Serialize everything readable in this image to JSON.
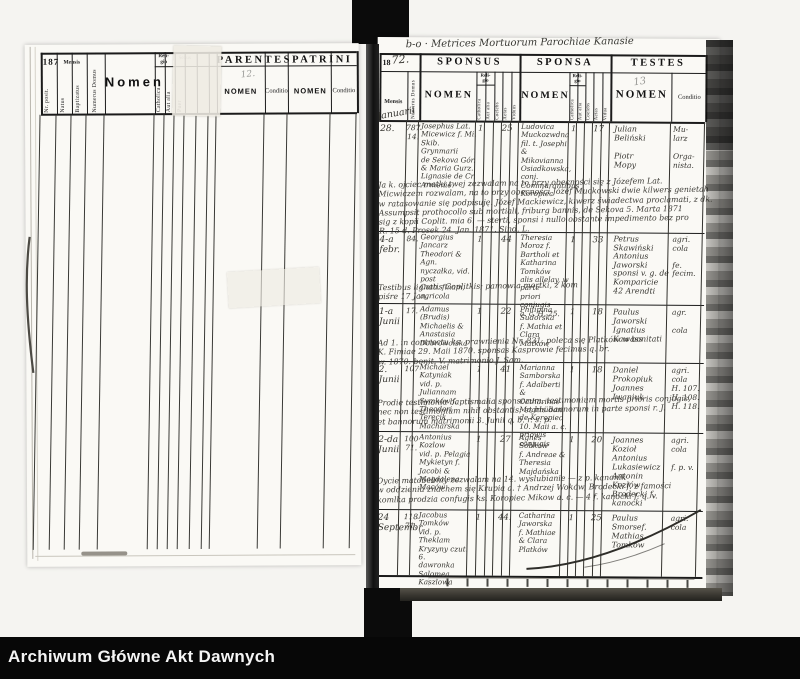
{
  "archive_bar": {
    "label": "Archiwum Główne Akt Dawnych"
  },
  "left_page": {
    "year": "187",
    "pencil_note": "12.",
    "header": {
      "nr_posit": "Nr. posit.",
      "mensis": "Mensis",
      "natus": "Natus",
      "baptizatus": "Baptizatus",
      "numerus_domus": "Numerus Domus",
      "nomen": "Nomen",
      "religio": "Reli-\ngio",
      "catholica": "Catholica",
      "aut_alia": "Aut alia",
      "sexus": "Sexus",
      "puer": "Puer",
      "parentes": "PARENTES",
      "parentes_nomen": "NOMEN",
      "parentes_conditio": "Conditio",
      "patrini": "PATRINI",
      "patrini_nomen": "NOMEN",
      "patrini_conditio": "Conditio"
    }
  },
  "right_page": {
    "title_hw": "b-o  ·  Metrices Mortuorum Parochiae Kanasie",
    "year_printed": "18",
    "year_hw": "72.",
    "page_no_hw": "13",
    "header": {
      "mensis": "Mensis",
      "mensis_hw": "Januarii",
      "numerus_domus": "Numerus Domus",
      "sponsus": "SPONSUS",
      "sponsa": "SPONSA",
      "testes": "TESTES",
      "nomen_sponsus": "NOMEN",
      "nomen_sponsa": "NOMEN",
      "nomen_testes": "NOMEN",
      "religio": "Reli-\ngio",
      "catholica": "Catholica",
      "aut_alia": "Aut alia",
      "coelebs": "Coelebs",
      "aetas": "Aetas",
      "viduus": "Viduus",
      "vidua": "Vidua",
      "conditio": "Conditio"
    },
    "rows": [
      {
        "mensis": "28.",
        "domus": "787\n14.",
        "sponsus": "Josephus Lat.\nMicewicz f. Mi.\nSkib. Grynmarii\nde Sekova Gór.\n& Maria Gurz.\nLignasie de Cr.\nArmenie.",
        "s_cath": "1",
        "s_aetas": "25",
        "sponsa": "Ludovica\nMuckozwdna\nfil. t. Josephi\n& Mikovianna\nOsiadkowska, conj.\nCommurantibus\nKoropiec",
        "sp_cath": "1",
        "sp_aetas": "17",
        "testes": "Julian\nBeliński\n\nPiotr\nMopy",
        "conditio": "Mu-\nlarz\n\nOrga-\nnista.",
        "note": "Ja k. ojciec matki twej zezwalam na to przy obecności się z Józefem Lat.\nMicwiczem rozwalam, na to przy obecności Józef Muckowski dwie kilwers genietah\nw ratasowanie się podpisuję. Józef Mackiewicz, kiwerz świadectwa proclamati, z dk.\nAssumpsit prothocollo sub mortiali, friburg bannis, de Sekova 5. Marta 1871\nsig z kopii Coplit. mia 6. — sterti, sponsi i nullo obstante impedimento bez pro\nR. 15 d. Prosek 24. Jan. 1871.  Sind. L."
      },
      {
        "mensis": "4-a\nfebr.",
        "domus": "84.",
        "sponsus": "Georgius\nJancarz\nTheodori & Agn.\nnyczałka, vid. post\nCath. finam, agricola",
        "s_cath": "1",
        "s_aetas": "44",
        "sponsa": "Theresia\nMoroz f.\nBartholi et\nKatharina\nTomków\nalis allelay, w parte\npriori conjugis\na. c. H. 25.",
        "sp_cath": "1",
        "sp_aetas": "33",
        "testes": "Petrus\nSkawiński\nAntonius\nJaworski\nsponsi v. g. de\nKomparicie\n42 Arendti",
        "conditio": "agri.\ncola\n\nfe.\nfecim.",
        "note": "Testibus lignatis Coplitkis; pamowia mortki, z kom piśre 17 Jan."
      },
      {
        "mensis": "1-a\nJunii",
        "domus": "17.",
        "sponsus": "Adamus\n(Brudis)\nMichaelis & Anastasia\nDobrowolska",
        "s_cath": "1",
        "s_aetas": "22",
        "sponsa": "Philipina\nSudorska\nf. Mathia et\nClara Matków",
        "sp_cath": "1",
        "sp_aetas": "18",
        "testes": "Paulus\nJaworski\nIgnatius\nKawass",
        "conditio": "agr.\n\ncola",
        "note": "Ad 1. in contractu ks. prawnienia Nr. 831, poleca się Platków w bonitati\nK. Fimiae 29. Maii 1870. sponsas Kasprowie fecimus q. br.\nw. 1870. bonit. V. matrimonio J. Sam."
      },
      {
        "mensis": "2.\nJunii",
        "domus": "107",
        "sponsus": "Michael\nKatyniak\nvid. p. Juliannam\nSymków f. Theodori\nTerecik Macharska",
        "s_cath": "1",
        "s_aetas": "41",
        "sponsa": "Marianna\nSamborska\nf. Adalberti\n& Catharinae\nMogrhüdan\nde Koropiec\n10. Maii a. c.\npriowis conjugis",
        "sp_cath": "1",
        "sp_aetas": "18",
        "testes": "Daniel\nProkopiuk\nJoannes\nIwaniuk",
        "conditio": "agri.\ncola\nH. 107.\nH. 108.\nH. 118.",
        "note": "Prodie testimonia baptismalia sponsorum, testimonium mortis prioris conjugis,\nnec non testimonium nihil obstantis; et his bannorum in parte sponsi r. J.\net bannorum matrimonii 3. Junii q. b. r. s. p."
      },
      {
        "mensis": "2-da\nJunii",
        "domus": "100\n71.",
        "sponsus": "Antonius\nKozlow\nvid. p. Pelagia\nMykietyn f. Jacobi &\nMagdalena Maców",
        "s_cath": "1",
        "s_aetas": "27",
        "sponsa": "Agnes\nSobków\nf. Andreae &\nTheresia\nMajdańska",
        "sp_cath": "1",
        "sp_aetas": "20",
        "testes": "Joannes\nKozioł\nAntonius\nLukasiewicz\nAntonin Kozłów\nBrodecki f. kanocki",
        "conditio": "agri.\ncola\n\nf. p. v.",
        "note": "Oycie matobebniy zezwalam na 14. wyslubianie — z p. kanonik\nw oddzieniu znachem się Krupia a. † Andrzej Woków, Brodecki f. z famości\nkomlka prodzia confugis ks. Koropiec Mikow a. c. — 4 f. kanocki f. q. v."
      },
      {
        "mensis": "24\nSeptembr.",
        "domus": "118\n71.",
        "sponsus": "Jacobus\nTomków\nvid. p. Theklam\nKryzyny czut. 6.\ndawronka Salomea\nKaszlowa",
        "s_cath": "1",
        "s_aetas": "44.",
        "sponsa": "Catharina\nJaworska\nf. Mathiae\n& Clara\nPlatków",
        "sp_cath": "1",
        "sp_aetas": "25",
        "testes": "Paulus\nSmorsef.\nMathias\nTomków",
        "conditio": "agri.\ncola",
        "note": ""
      }
    ]
  }
}
